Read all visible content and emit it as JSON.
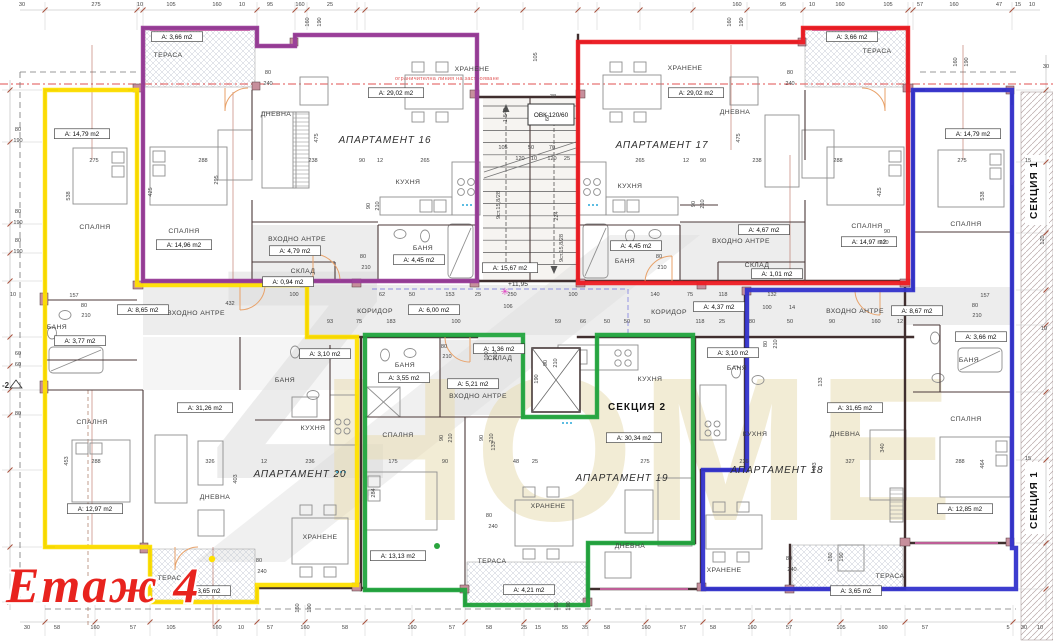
{
  "title": "Етаж 4",
  "watermark_z": "Z",
  "watermark_text": "НОМЕ",
  "boundary_note": "ограничителна линия на застрояване",
  "hvac": "ОВК 120/60",
  "level_mark": "+11,95",
  "axis_label": "-2",
  "star_glyph": "✳",
  "sections": {
    "section1": "СЕКЦИЯ 1",
    "section2": "СЕКЦИЯ 2"
  },
  "colors": {
    "apt16": "#993d99",
    "apt17": "#ee1c23",
    "apt18": "#3333cc",
    "apt19": "#22a53e",
    "apt20": "#ffe000",
    "title_red": "#e8231e",
    "walls": "#402e2e",
    "regulation_line": "#e05050"
  },
  "apartments": [
    {
      "name": "АПАРТАМЕНТ 16",
      "color": "#993d99"
    },
    {
      "name": "АПАРТАМЕНТ 17",
      "color": "#ee1c23"
    },
    {
      "name": "АПАРТАМЕНТ 18",
      "color": "#3333cc"
    },
    {
      "name": "АПАРТАМЕНТ 19",
      "color": "#22a53e"
    },
    {
      "name": "АПАРТАМЕНТ 20",
      "color": "#ffe000"
    }
  ],
  "apartment_labels": [
    [
      "АПАРТАМЕНТ 16",
      385,
      143
    ],
    [
      "АПАРТАМЕНТ 17",
      662,
      148
    ],
    [
      "АПАРТАМЕНТ 18",
      777,
      473
    ],
    [
      "АПАРТАМЕНТ 19",
      622,
      481
    ],
    [
      "АПАРТАМЕНТ 20",
      300,
      477
    ]
  ],
  "room_labels": [
    [
      "ТЕРАСА",
      168,
      57
    ],
    [
      "ХРАНЕНЕ",
      472,
      71
    ],
    [
      "ДНЕВНА",
      276,
      116
    ],
    [
      "КУХНЯ",
      408,
      184
    ],
    [
      "СПАЛНЯ",
      95,
      229
    ],
    [
      "СПАЛНЯ",
      184,
      233
    ],
    [
      "ВХОДНО АНТРЕ",
      297,
      241
    ],
    [
      "БАНЯ",
      423,
      250
    ],
    [
      "СКЛАД",
      303,
      273
    ],
    [
      "БАНЯ",
      57,
      329
    ],
    [
      "ВХОДНО АНТРЕ",
      196,
      315
    ],
    [
      "КОРИДОР",
      375,
      313
    ],
    [
      "БАНЯ",
      285,
      382
    ],
    [
      "КУХНЯ",
      313,
      430
    ],
    [
      "БАНЯ",
      405,
      367
    ],
    [
      "СПАЛНЯ",
      398,
      437
    ],
    [
      "СКЛАД",
      500,
      360
    ],
    [
      "ВХОДНО АНТРЕ",
      478,
      398
    ],
    [
      "ХРАНЕНЕ",
      685,
      70
    ],
    [
      "ДНЕВНА",
      735,
      114
    ],
    [
      "КУХНЯ",
      630,
      188
    ],
    [
      "БАНЯ",
      625,
      263
    ],
    [
      "ВХОДНО АНТРЕ",
      741,
      243
    ],
    [
      "СКЛАД",
      757,
      267
    ],
    [
      "КОРИДОР",
      669,
      314
    ],
    [
      "БАНЯ",
      737,
      370
    ],
    [
      "КУХНЯ",
      650,
      381
    ],
    [
      "КУХНЯ",
      755,
      436
    ],
    [
      "СПАЛНЯ",
      867,
      228
    ],
    [
      "СПАЛНЯ",
      966,
      226
    ],
    [
      "ВХОДНО АНТРЕ",
      855,
      313
    ],
    [
      "БАНЯ",
      969,
      362
    ],
    [
      "СПАЛНЯ",
      966,
      421
    ],
    [
      "ДНЕВНА",
      845,
      436
    ],
    [
      "СПАЛНЯ",
      92,
      424
    ],
    [
      "ДНЕВНА",
      215,
      499
    ],
    [
      "ХРАНЕНЕ",
      320,
      539
    ],
    [
      "ХРАНЕНЕ",
      548,
      508
    ],
    [
      "ДНЕВНА",
      630,
      548
    ],
    [
      "ХРАНЕНЕ",
      724,
      572
    ],
    [
      "ТЕРАСА",
      172,
      580
    ],
    [
      "ТЕРАСА",
      492,
      563
    ],
    [
      "ТЕРАСА",
      890,
      578
    ],
    [
      "ТЕРАСА",
      877,
      53
    ]
  ],
  "area_labels": [
    [
      "А: 3,66 m2",
      177,
      39
    ],
    [
      "А: 14,79 m2",
      82,
      136
    ],
    [
      "А: 29,02 m2",
      396,
      95
    ],
    [
      "А: 4,79 m2",
      295,
      253
    ],
    [
      "А: 0,94 m2",
      288,
      284
    ],
    [
      "А: 4,45 m2",
      419,
      262
    ],
    [
      "А: 14,96 m2",
      184,
      247
    ],
    [
      "А: 8,65 m2",
      143,
      312
    ],
    [
      "А: 3,77 m2",
      80,
      343
    ],
    [
      "А: 31,26 m2",
      205,
      410
    ],
    [
      "А: 6,00 m2",
      434,
      312
    ],
    [
      "А: 3,10 m2",
      325,
      356
    ],
    [
      "А: 3,55 m2",
      404,
      380
    ],
    [
      "А: 1,36 m2",
      499,
      351
    ],
    [
      "А: 5,21 m2",
      473,
      386
    ],
    [
      "А: 15,67 m2",
      510,
      270
    ],
    [
      "А: 29,02 m2",
      696,
      95
    ],
    [
      "А: 4,45 m2",
      636,
      248
    ],
    [
      "А: 4,67 m2",
      764,
      232
    ],
    [
      "А: 1,01 m2",
      777,
      276
    ],
    [
      "А: 4,37 m2",
      719,
      309
    ],
    [
      "А: 3,66 m2",
      852,
      39
    ],
    [
      "А: 14,97 m2",
      869,
      244
    ],
    [
      "А: 14,79 m2",
      973,
      136
    ],
    [
      "А: 8,67 m2",
      917,
      313
    ],
    [
      "А: 3,66 m2",
      981,
      339
    ],
    [
      "А: 31,65 m2",
      855,
      410
    ],
    [
      "А: 12,85 m2",
      965,
      511
    ],
    [
      "А: 3,10 m2",
      733,
      355
    ],
    [
      "А: 30,34 m2",
      634,
      440
    ],
    [
      "А: 12,97 m2",
      95,
      511
    ],
    [
      "А: 13,13 m2",
      398,
      558
    ],
    [
      "А: 4,21 m2",
      529,
      592
    ],
    [
      "А: 3,65 m2",
      205,
      593
    ],
    [
      "А: 3,65 m2",
      856,
      593
    ]
  ],
  "dimensions": [
    [
      "30",
      22,
      6
    ],
    [
      "275",
      96,
      6
    ],
    [
      "10",
      140,
      6
    ],
    [
      "105",
      171,
      6
    ],
    [
      "160",
      217,
      6
    ],
    [
      "10",
      242,
      6
    ],
    [
      "95",
      270,
      6
    ],
    [
      "160",
      300,
      6
    ],
    [
      "25",
      330,
      6
    ],
    [
      "160",
      737,
      6
    ],
    [
      "95",
      783,
      6
    ],
    [
      "10",
      812,
      6
    ],
    [
      "160",
      840,
      6
    ],
    [
      "105",
      888,
      6
    ],
    [
      "57",
      920,
      6
    ],
    [
      "160",
      954,
      6
    ],
    [
      "47",
      999,
      6
    ],
    [
      "15",
      1018,
      6
    ],
    [
      "10",
      1032,
      6
    ],
    [
      "160",
      309,
      22,
      1
    ],
    [
      "190",
      321,
      22,
      1
    ],
    [
      "160",
      731,
      22,
      1
    ],
    [
      "190",
      743,
      22,
      1
    ],
    [
      "160",
      957,
      62,
      1
    ],
    [
      "190",
      968,
      62,
      1
    ],
    [
      "30",
      27,
      629
    ],
    [
      "58",
      57,
      629
    ],
    [
      "160",
      95,
      629
    ],
    [
      "57",
      133,
      629
    ],
    [
      "105",
      171,
      629
    ],
    [
      "160",
      217,
      629
    ],
    [
      "10",
      241,
      629
    ],
    [
      "57",
      270,
      629
    ],
    [
      "160",
      305,
      629
    ],
    [
      "58",
      345,
      629
    ],
    [
      "160",
      412,
      629
    ],
    [
      "57",
      452,
      629
    ],
    [
      "58",
      489,
      629
    ],
    [
      "25",
      524,
      629
    ],
    [
      "15",
      538,
      629
    ],
    [
      "55",
      565,
      629
    ],
    [
      "35",
      585,
      629
    ],
    [
      "58",
      607,
      629
    ],
    [
      "160",
      646,
      629
    ],
    [
      "57",
      683,
      629
    ],
    [
      "58",
      713,
      629
    ],
    [
      "160",
      752,
      629
    ],
    [
      "57",
      789,
      629
    ],
    [
      "105",
      841,
      629
    ],
    [
      "160",
      883,
      629
    ],
    [
      "57",
      925,
      629
    ],
    [
      "5",
      1008,
      629
    ],
    [
      "30",
      1024,
      629
    ],
    [
      "10",
      1040,
      629
    ],
    [
      "160",
      299,
      608,
      1
    ],
    [
      "190",
      311,
      608,
      1
    ],
    [
      "160",
      558,
      606,
      1
    ],
    [
      "190",
      570,
      606,
      1
    ],
    [
      "160",
      832,
      557,
      1
    ],
    [
      "190",
      843,
      557,
      1
    ],
    [
      "80",
      18,
      131
    ],
    [
      "190",
      18,
      142
    ],
    [
      "80",
      18,
      213
    ],
    [
      "190",
      18,
      224
    ],
    [
      "80",
      18,
      242
    ],
    [
      "190",
      18,
      253
    ],
    [
      "60",
      18,
      355
    ],
    [
      "60",
      18,
      366
    ],
    [
      "80",
      18,
      415
    ],
    [
      "10",
      13,
      296
    ],
    [
      "30",
      1046,
      68
    ],
    [
      "15",
      1028,
      162
    ],
    [
      "120",
      1044,
      240,
      1
    ],
    [
      "15",
      1028,
      460
    ],
    [
      "10",
      1044,
      330
    ],
    [
      "100",
      294,
      296
    ],
    [
      "62",
      382,
      296
    ],
    [
      "50",
      412,
      296
    ],
    [
      "153",
      450,
      296
    ],
    [
      "25",
      478,
      296
    ],
    [
      "250",
      512,
      296
    ],
    [
      "100",
      573,
      296
    ],
    [
      "140",
      655,
      296
    ],
    [
      "75",
      690,
      296
    ],
    [
      "118",
      723,
      296
    ],
    [
      "132",
      772,
      296
    ],
    [
      "432",
      230,
      305
    ],
    [
      "106",
      508,
      308
    ],
    [
      "100",
      767,
      309
    ],
    [
      "14",
      792,
      309
    ],
    [
      "93",
      330,
      323
    ],
    [
      "75",
      359,
      323
    ],
    [
      "183",
      391,
      323
    ],
    [
      "100",
      456,
      323
    ],
    [
      "59",
      558,
      323
    ],
    [
      "66",
      583,
      323
    ],
    [
      "50",
      607,
      323
    ],
    [
      "50",
      627,
      323
    ],
    [
      "50",
      647,
      323
    ],
    [
      "118",
      700,
      323
    ],
    [
      "25",
      722,
      323
    ],
    [
      "80",
      752,
      323
    ],
    [
      "50",
      790,
      323
    ],
    [
      "157",
      74,
      297
    ],
    [
      "80",
      84,
      307
    ],
    [
      "210",
      86,
      317
    ],
    [
      "157",
      985,
      297
    ],
    [
      "80",
      975,
      307
    ],
    [
      "210",
      977,
      317
    ],
    [
      "90",
      832,
      323
    ],
    [
      "160",
      876,
      323
    ],
    [
      "12",
      900,
      323
    ],
    [
      "275",
      94,
      162
    ],
    [
      "288",
      203,
      162
    ],
    [
      "238",
      313,
      162
    ],
    [
      "90",
      362,
      162
    ],
    [
      "12",
      380,
      162
    ],
    [
      "265",
      425,
      162
    ],
    [
      "265",
      640,
      162
    ],
    [
      "12",
      686,
      162
    ],
    [
      "90",
      703,
      162
    ],
    [
      "238",
      757,
      162
    ],
    [
      "288",
      838,
      162
    ],
    [
      "275",
      962,
      162
    ],
    [
      "538",
      70,
      196,
      1
    ],
    [
      "425",
      152,
      192,
      1
    ],
    [
      "295",
      218,
      180,
      1
    ],
    [
      "475",
      318,
      138,
      1
    ],
    [
      "475",
      740,
      138,
      1
    ],
    [
      "425",
      881,
      192,
      1
    ],
    [
      "538",
      984,
      196,
      1
    ],
    [
      "453",
      68,
      461,
      1
    ],
    [
      "288",
      96,
      463
    ],
    [
      "326",
      210,
      463
    ],
    [
      "403",
      237,
      479,
      1
    ],
    [
      "12",
      264,
      463
    ],
    [
      "236",
      310,
      463
    ],
    [
      "175",
      393,
      463
    ],
    [
      "284",
      375,
      493,
      1
    ],
    [
      "90",
      445,
      463
    ],
    [
      "48",
      516,
      463
    ],
    [
      "25",
      535,
      463
    ],
    [
      "275",
      645,
      463
    ],
    [
      "236",
      744,
      463
    ],
    [
      "327",
      850,
      463
    ],
    [
      "340",
      884,
      448,
      1
    ],
    [
      "403",
      816,
      467,
      1
    ],
    [
      "288",
      960,
      463
    ],
    [
      "464",
      984,
      464,
      1
    ],
    [
      "80",
      268,
      74
    ],
    [
      "240",
      268,
      85
    ],
    [
      "80",
      790,
      74
    ],
    [
      "240",
      790,
      85
    ],
    [
      "80",
      363,
      258
    ],
    [
      "210",
      366,
      269
    ],
    [
      "80",
      659,
      258
    ],
    [
      "210",
      662,
      269
    ],
    [
      "80",
      444,
      348
    ],
    [
      "210",
      447,
      358
    ],
    [
      "90",
      887,
      233
    ],
    [
      "210",
      884,
      244
    ],
    [
      "80",
      259,
      562
    ],
    [
      "240",
      262,
      573
    ],
    [
      "80",
      789,
      560
    ],
    [
      "240",
      792,
      571
    ],
    [
      "80",
      489,
      517
    ],
    [
      "240",
      493,
      528
    ],
    [
      "90",
      370,
      206,
      1
    ],
    [
      "210",
      379,
      206,
      1
    ],
    [
      "90",
      695,
      204,
      1
    ],
    [
      "210",
      704,
      204,
      1
    ],
    [
      "90",
      443,
      438,
      1
    ],
    [
      "210",
      452,
      438,
      1
    ],
    [
      "90",
      483,
      438,
      1
    ],
    [
      "210",
      493,
      438,
      1
    ],
    [
      "80",
      767,
      344,
      1
    ],
    [
      "210",
      777,
      344,
      1
    ],
    [
      "90",
      547,
      363,
      1
    ],
    [
      "210",
      557,
      363,
      1
    ],
    [
      "190",
      538,
      379,
      1
    ],
    [
      "100",
      488,
      356,
      1
    ],
    [
      "210",
      497,
      356,
      1
    ],
    [
      "133",
      495,
      446,
      1
    ],
    [
      "133",
      822,
      382,
      1
    ],
    [
      "105",
      503,
      149
    ],
    [
      "50",
      531,
      149
    ],
    [
      "70",
      552,
      149
    ],
    [
      "120",
      520,
      160
    ],
    [
      "10",
      534,
      160
    ],
    [
      "120",
      552,
      160
    ],
    [
      "25",
      567,
      160
    ],
    [
      "224",
      558,
      216,
      1
    ],
    [
      "9ст.15,8/28",
      500,
      205,
      1
    ],
    [
      "9ст.15,8/28",
      563,
      248,
      1
    ],
    [
      "1-540",
      507,
      115,
      1
    ],
    [
      "38",
      553,
      98
    ],
    [
      "60",
      549,
      118,
      1
    ],
    [
      "105",
      537,
      57,
      1
    ]
  ]
}
